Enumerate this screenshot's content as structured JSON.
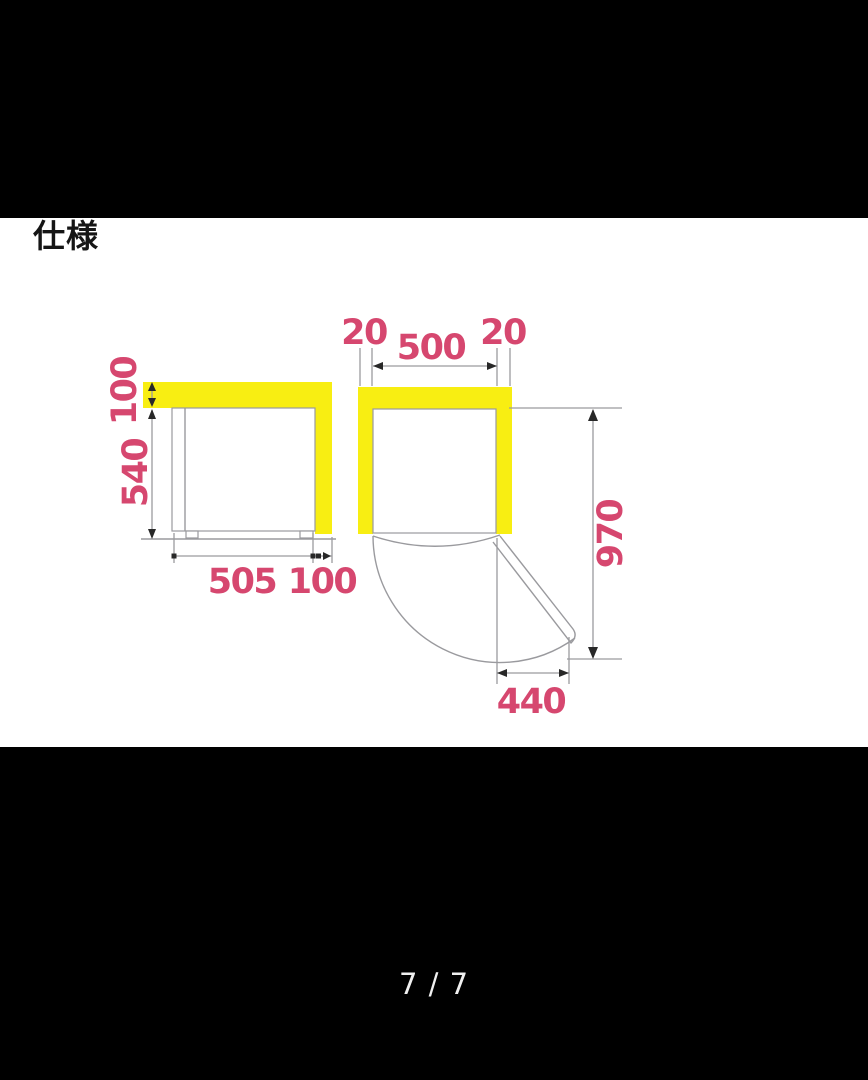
{
  "viewer": {
    "page_indicator": "7 / 7"
  },
  "image": {
    "title": "仕様",
    "colors": {
      "highlight": "#f8ee12",
      "dimension_text": "#d6476f",
      "line": "#9a9a9e",
      "arrow": "#282828"
    },
    "side_view": {
      "top_clearance_mm": "100",
      "height_mm": "540",
      "depth_mm": "505",
      "rear_clearance_mm": "100"
    },
    "top_view": {
      "left_clearance_mm": "20",
      "width_mm": "500",
      "right_clearance_mm": "20",
      "open_depth_mm": "970",
      "door_open_width_mm": "440"
    }
  }
}
